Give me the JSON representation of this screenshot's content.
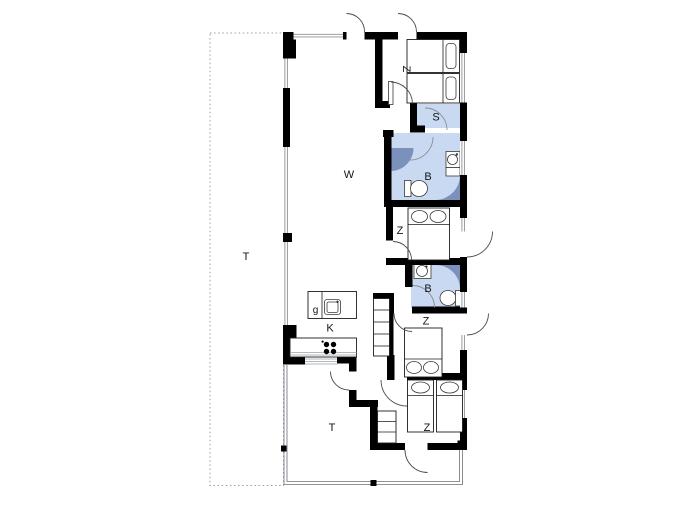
{
  "plan": {
    "title": "holiday-house floor plan",
    "labels": {
      "terrace_west": "T",
      "living_room": "W",
      "kitchen": "K",
      "kitchen_island": "g",
      "bedroom_top": "Z",
      "sauna": "S",
      "bathroom_top": "B",
      "bedroom_middle": "Z",
      "bathroom_lower": "B",
      "bedroom_lower": "Z",
      "bedroom_bottom": "Z",
      "terrace_south": "T"
    },
    "colors": {
      "wall": "#000000",
      "wet_room_floor": "#c9d9f1",
      "shower": "#7b90ba",
      "terrace_outline": "#9aa0a6"
    }
  }
}
